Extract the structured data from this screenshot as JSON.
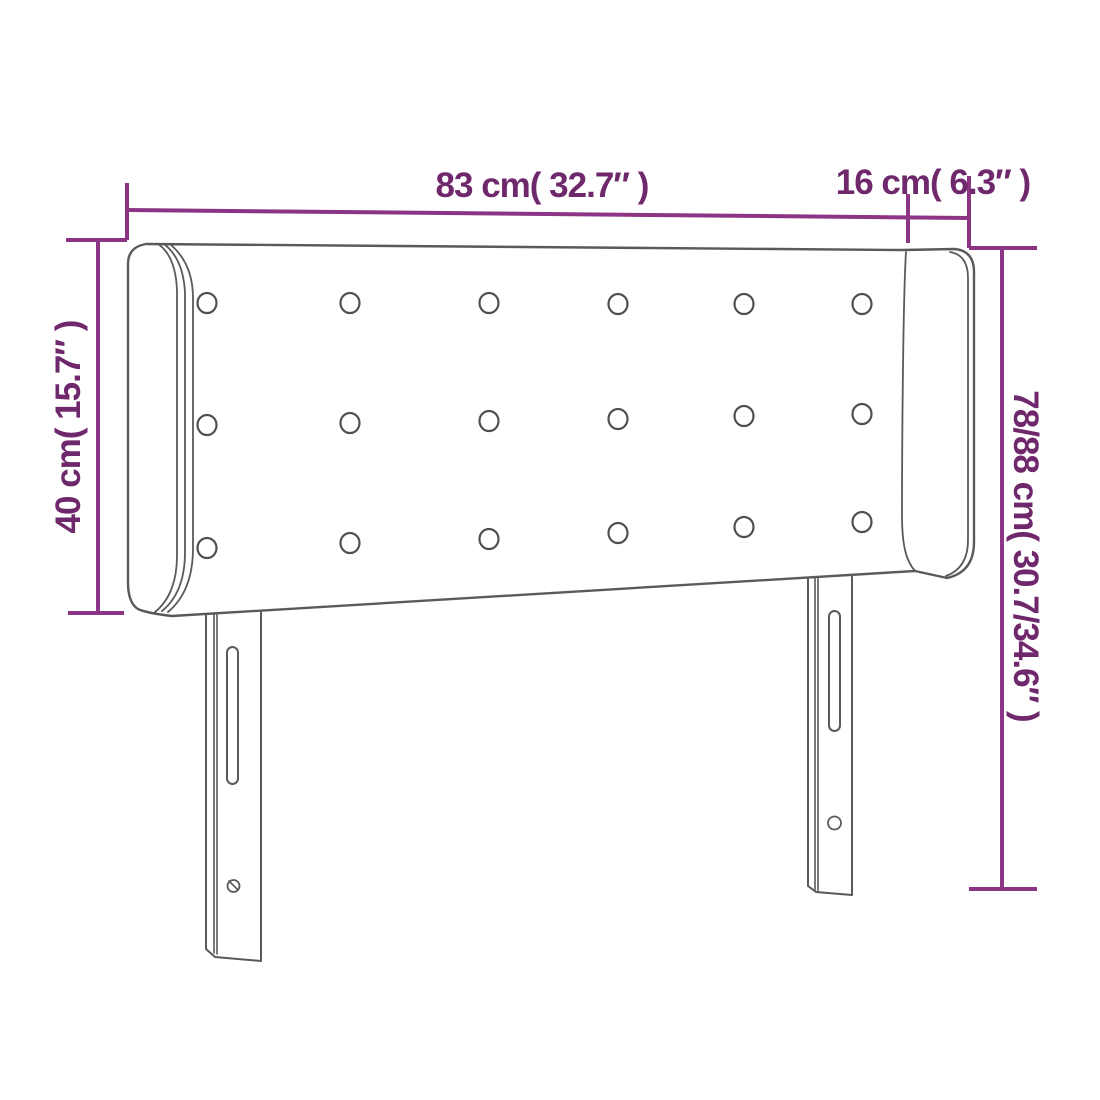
{
  "diagram": {
    "product_drawing": "headboard with side ears, button tufting and two mounting legs",
    "colors": {
      "dimension_line": "#8c3585",
      "dimension_text": "#6f286b",
      "drawing_outline": "#595a5c",
      "background": "#ffffff"
    },
    "dimensions": {
      "top_width": "83 cm( 32.7″ )",
      "top_ear": "16 cm( 6.3″ )",
      "left_height": "40 cm( 15.7″ )",
      "right_total_height": "78/88 cm( 30.7/34.6″ )"
    },
    "tuft_buttons": {
      "rows": 3,
      "columns": 6,
      "total": 18
    }
  }
}
